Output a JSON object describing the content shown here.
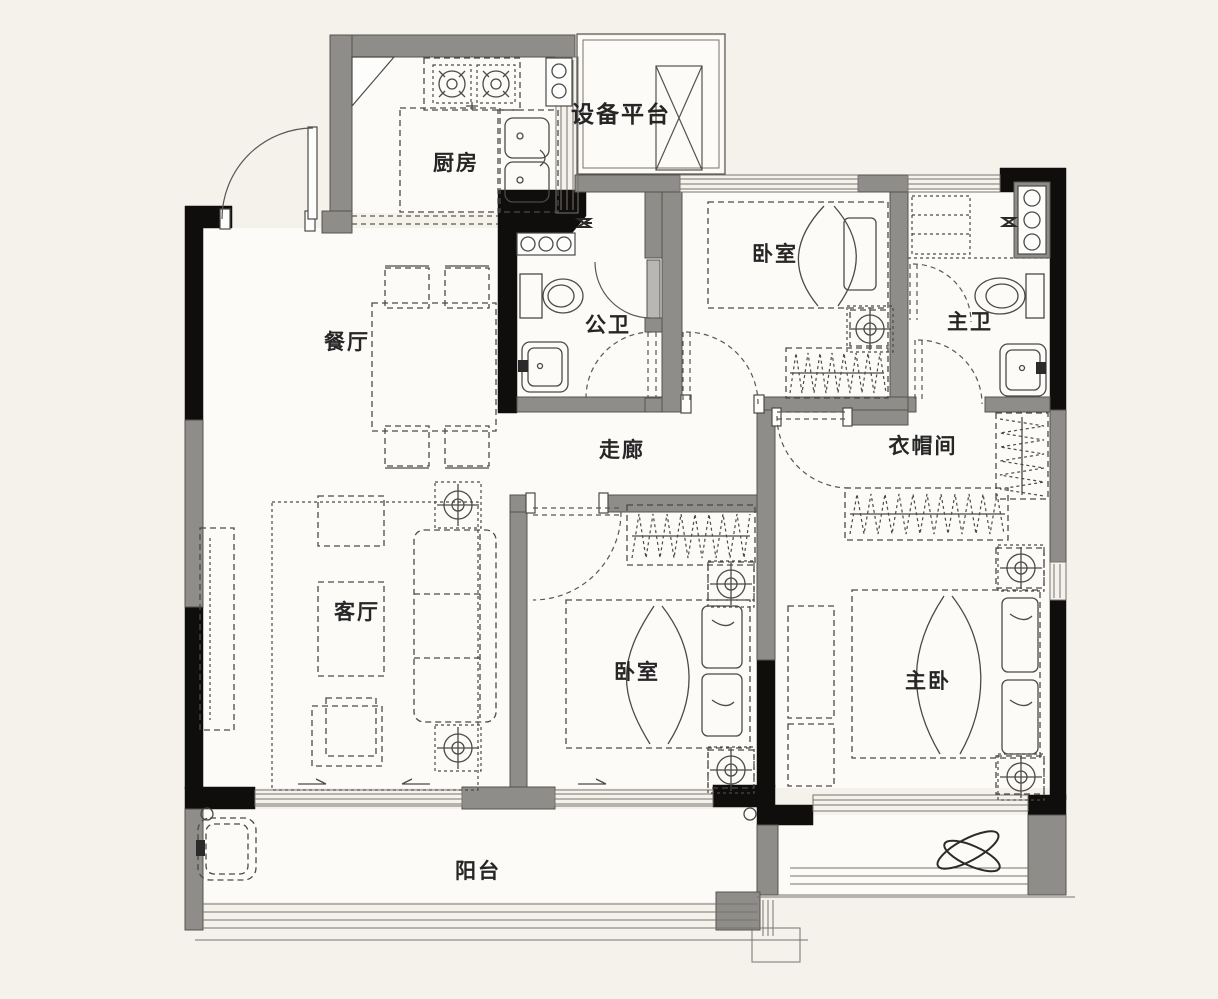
{
  "title": "三室两厅户型图",
  "rooms": [
    {
      "id": "kitchen",
      "label": "厨房"
    },
    {
      "id": "equipment-platform",
      "label": "设备平台"
    },
    {
      "id": "dining",
      "label": "餐厅"
    },
    {
      "id": "public-bath",
      "label": "公卫"
    },
    {
      "id": "bedroom-north",
      "label": "卧室"
    },
    {
      "id": "master-bath",
      "label": "主卫"
    },
    {
      "id": "corridor",
      "label": "走廊"
    },
    {
      "id": "cloakroom",
      "label": "衣帽间"
    },
    {
      "id": "living",
      "label": "客厅"
    },
    {
      "id": "bedroom-south",
      "label": "卧室"
    },
    {
      "id": "master-bedroom",
      "label": "主卧"
    },
    {
      "id": "balcony",
      "label": "阳台"
    }
  ],
  "colors": {
    "background": "#f5f2ec",
    "floor": "#fcfbf8",
    "wall_structural": "#0f0e0c",
    "wall_infill": "#8f8d8a",
    "furniture_line": "#4b4a48"
  }
}
